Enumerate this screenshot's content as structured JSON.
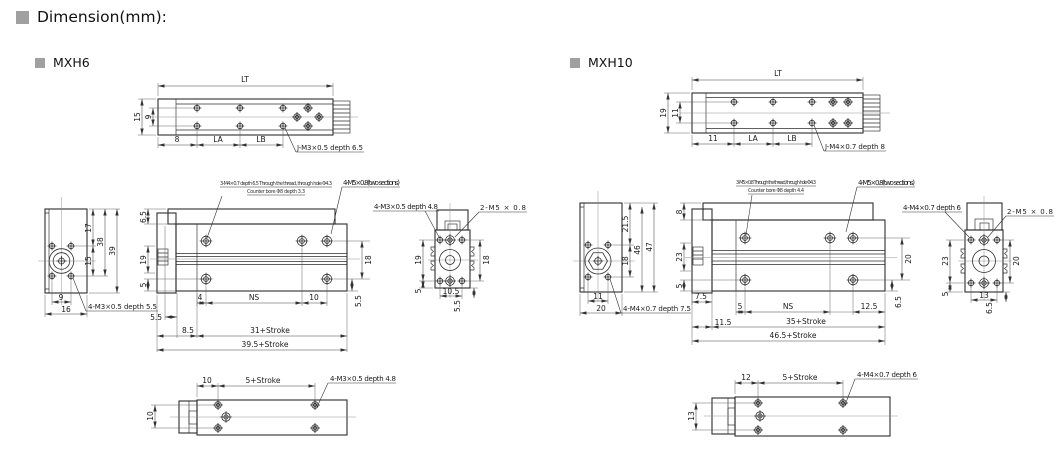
{
  "page": {
    "title": "Dimension(mm):"
  },
  "mxh6": {
    "label": "MXH6",
    "top": {
      "lt": "LT",
      "h": "15",
      "hi": "9",
      "m1": "8",
      "la": "LA",
      "lb": "LB",
      "leader": "J-M3×0.5 depth 6.5"
    },
    "end": {
      "d1": "17",
      "d2": "38",
      "d3": "39",
      "d4": "15",
      "b1": "9",
      "b2": "16",
      "leader": "4-M3×0.5 depth 5.5"
    },
    "side": {
      "note1": "3-M4×0.7 depth 6.5 Through the thread, through hole Φ4.3",
      "note2": "Counter bore Φ8 depth 3.3",
      "ports": "4-M5×0.8(two sections)",
      "l1": "6.5",
      "l2": "19",
      "l3": "5",
      "r1": "18",
      "r2": "5.5",
      "b1": "4",
      "b2": "NS",
      "b3": "10",
      "b4": "5.5",
      "b5": "8.5",
      "s1": "31+Stroke",
      "s2": "39.5+Stroke"
    },
    "port": {
      "leader1": "4-M3×0.5 depth 4.8",
      "leader2": "2-M5 × 0.8",
      "l1": "19",
      "l2": "5",
      "r1": "18",
      "b1": "10.5",
      "b2": "5.5"
    },
    "bottom": {
      "t1": "10",
      "t2": "5+Stroke",
      "leader": "4-M3×0.5 depth 4.8",
      "left": "10"
    }
  },
  "mxh10": {
    "label": "MXH10",
    "top": {
      "lt": "LT",
      "h": "19",
      "hi": "11",
      "m1": "11",
      "la": "LA",
      "lb": "LB",
      "leader": "J-M4×0.7 depth 8"
    },
    "end": {
      "d1": "21.5",
      "d2": "46",
      "d3": "47",
      "d4": "18",
      "b1": "11",
      "b2": "20",
      "leader": "4-M4×0.7 depth 7.5"
    },
    "side": {
      "note1": "3-M5×0.8 Through the thread, through hole Φ4.3",
      "note2": "Counter bore Φ8 depth 4.4",
      "ports": "4-M5×0.8(two sections)",
      "l1": "8",
      "l2": "23",
      "l3": "5",
      "r1": "20",
      "r2": "6.5",
      "b1": "5",
      "b2": "NS",
      "b3": "12.5",
      "b4": "7.5",
      "b5": "11.5",
      "s1": "35+Stroke",
      "s2": "46.5+Stroke"
    },
    "port": {
      "leader1": "4-M4×0.7 depth 6",
      "leader2": "2-M5 × 0.8",
      "l1": "23",
      "l2": "5",
      "r1": "20",
      "b1": "13",
      "b2": "6.5"
    },
    "bottom": {
      "t1": "12",
      "t2": "5+Stroke",
      "leader": "4-M4×0.7 depth 6",
      "left": "13"
    }
  }
}
